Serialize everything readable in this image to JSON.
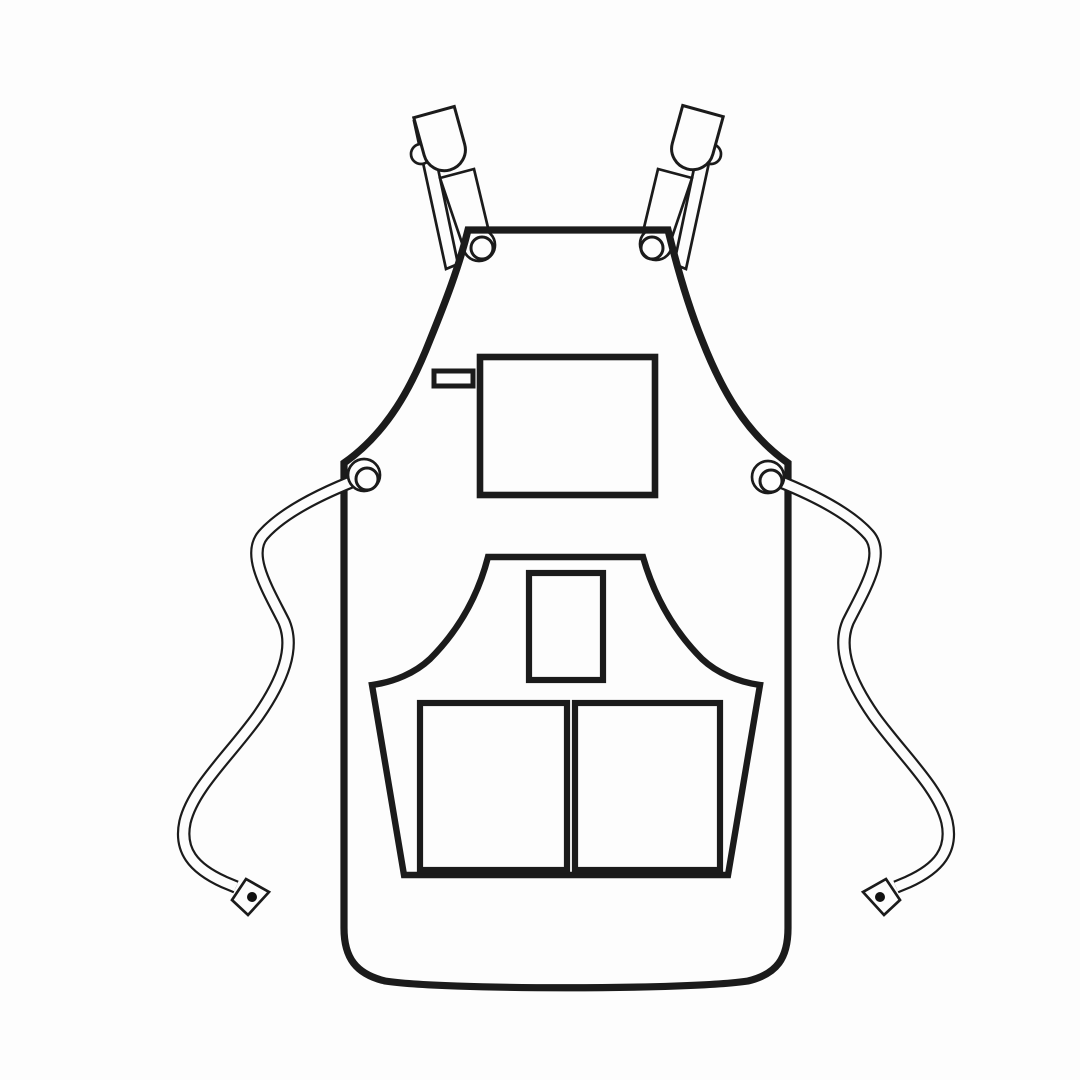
{
  "colors": {
    "line": "#1b1b1b",
    "fill": "#fdfdfd",
    "background": "#fdfdfd",
    "dot": "#111111"
  },
  "illustration": {
    "subject": "bib apron technical flat sketch, front view, black outline on white",
    "parts": [
      "left-shoulder-strap",
      "right-shoulder-strap",
      "left-strap-clip",
      "right-strap-clip",
      "left-bib-grommet",
      "right-bib-grommet",
      "chest-pocket",
      "pen-slot",
      "lower-pocket-panel",
      "center-tool-pocket",
      "left-main-pocket",
      "right-main-pocket",
      "left-waist-grommet",
      "right-waist-grommet",
      "left-waist-tie",
      "right-waist-tie",
      "left-tie-aglet",
      "right-tie-aglet"
    ]
  }
}
